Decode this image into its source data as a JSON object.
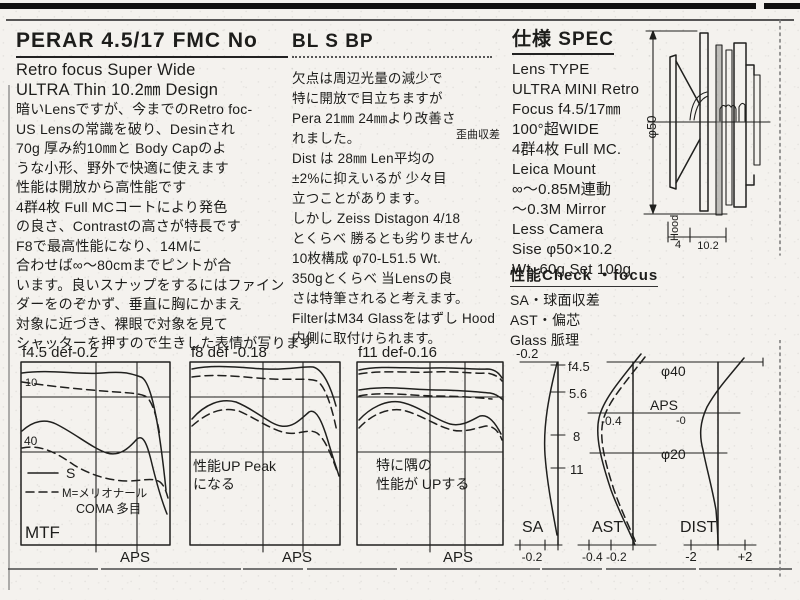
{
  "left": {
    "title": "PERAR 4.5/17 FMC No",
    "lines": [
      "Retro focus Super Wide",
      "ULTRA Thin 10.2㎜ Design",
      "暗いLensですが、今までのRetro foc-",
      "US Lensの常識を破り、Desinされ",
      "70g 厚み約10㎜と Body Capのよ",
      "うな小形、野外で快適に使えます",
      "性能は開放から高性能です",
      "4群4枚 Full MCコートにより発色",
      "の良さ、Contrastの高さが特長です",
      "F8で最高性能になり、14Mに",
      "合わせば∞〜80cmまでピントが合",
      "います。良いスナップをするにはファイン",
      "ダーをのぞかず、垂直に胸にかまえ",
      "対象に近づき、裸眼で対象を見て",
      "シャッターを押すので生きした表情が写ります"
    ]
  },
  "middle": {
    "title": "BL S BP",
    "annotation": "歪曲収差",
    "lines": [
      "欠点は周辺光量の減少で",
      "特に開放で目立ちますが",
      "Pera 21㎜ 24㎜より改善さ",
      "れました。",
      "Dist は 28㎜ Len平均の",
      "±2%に抑えいるが 少々目",
      "立つことがあります。",
      "しかし Zeiss Distagon 4/18",
      "とくらべ 勝るとも劣りません",
      "10枚構成 φ70-L51.5 Wt.",
      "350gとくらべ 当Lensの良",
      "さは特筆されると考えます。",
      "FilterはM34 Glassをはずし Hood",
      "内側に取付けられます。"
    ]
  },
  "spec": {
    "title": "仕様 SPEC",
    "lines": [
      "Lens TYPE",
      "ULTRA MINI Retro",
      "Focus f4.5/17㎜",
      "100°超WIDE",
      "4群4枚 Full MC.",
      "Leica Mount",
      "∞〜0.85M連動",
      "〜0.3M Mirror",
      "Less Camera",
      "Sise φ50×10.2",
      "Wt. 60g Set 100g"
    ]
  },
  "check": {
    "title": "性能Check ・focus",
    "lines": [
      "SA・球面収差",
      "AST・偏芯",
      "Glass 脈理"
    ]
  },
  "diagram": {
    "diameter": "φ50",
    "hood": "Hood",
    "dim_a": "4",
    "dim_b": "10.2"
  },
  "charts": {
    "mtf1": {
      "title": "f4.5 def-0.2",
      "freq_hi": "10",
      "freq_lo": "40",
      "legend_s": "S",
      "legend_m": "M=メリオナール",
      "legend_note": "COMA 多目",
      "corner": "MTF",
      "xlabel": "APS"
    },
    "mtf2": {
      "title": "f8 def -0.18",
      "note1": "性能UP Peak",
      "note2": "になる",
      "xlabel": "APS"
    },
    "mtf3": {
      "title": "f11 def-0.16",
      "note1": "特に隅の",
      "note2": "性能が UPする",
      "xlabel": "APS"
    },
    "sa": {
      "top": "-0.2",
      "stop1": "f4.5",
      "stop2": "5.6",
      "stop3": "8",
      "stop4": "11",
      "name": "SA",
      "bottom": "-0.2"
    },
    "ast": {
      "label": "-0.4",
      "name": "AST",
      "bottom": "-0.4 -0.2"
    },
    "dist": {
      "d40": "φ40",
      "aps": "APS",
      "minus0": "-0",
      "d20": "φ20",
      "name": "DIST",
      "neg": "-2",
      "pos": "+2"
    }
  },
  "chart_data": [
    {
      "type": "line",
      "title": "f4.5 def-0.2",
      "ylabel": "MTF",
      "xlabel": "image height → APS corner",
      "x": [
        0,
        0.25,
        0.5,
        0.75,
        1
      ],
      "series": [
        {
          "name": "10 lp/mm S",
          "style": "solid",
          "values": [
            0.93,
            0.92,
            0.92,
            0.9,
            0.55
          ]
        },
        {
          "name": "10 lp/mm M",
          "style": "dashed",
          "values": [
            0.88,
            0.85,
            0.82,
            0.78,
            0.62
          ]
        },
        {
          "name": "40 lp/mm S",
          "style": "solid",
          "values": [
            0.62,
            0.55,
            0.45,
            0.52,
            0.12
          ]
        },
        {
          "name": "40 lp/mm M",
          "style": "dashed",
          "values": [
            0.52,
            0.42,
            0.33,
            0.3,
            0.2
          ]
        }
      ],
      "annotations": [
        "S",
        "M=メリオナール",
        "COMA 多目",
        "MTF",
        "APS"
      ]
    },
    {
      "type": "line",
      "title": "f8 def -0.18",
      "ylabel": "MTF",
      "xlabel": "image height → APS corner",
      "x": [
        0,
        0.25,
        0.5,
        0.75,
        1
      ],
      "series": [
        {
          "name": "10 lp/mm S",
          "style": "solid",
          "values": [
            0.95,
            0.95,
            0.94,
            0.95,
            0.7
          ]
        },
        {
          "name": "10 lp/mm M",
          "style": "dashed",
          "values": [
            0.9,
            0.88,
            0.87,
            0.88,
            0.55
          ]
        },
        {
          "name": "40 lp/mm S",
          "style": "solid",
          "values": [
            0.68,
            0.72,
            0.6,
            0.65,
            0.35
          ]
        },
        {
          "name": "40 lp/mm M",
          "style": "dashed",
          "values": [
            0.64,
            0.66,
            0.56,
            0.58,
            0.38
          ]
        }
      ],
      "annotations": [
        "性能UP Peakになる",
        "APS"
      ]
    },
    {
      "type": "line",
      "title": "f11 def-0.16",
      "ylabel": "MTF",
      "xlabel": "image height → APS corner",
      "x": [
        0,
        0.25,
        0.5,
        0.75,
        1
      ],
      "series": [
        {
          "name": "10 lp/mm S",
          "style": "solid",
          "values": [
            0.94,
            0.95,
            0.94,
            0.94,
            0.9
          ]
        },
        {
          "name": "10 lp/mm M",
          "style": "dashed",
          "values": [
            0.86,
            0.88,
            0.86,
            0.85,
            0.82
          ]
        },
        {
          "name": "40 lp/mm S",
          "style": "solid",
          "values": [
            0.65,
            0.73,
            0.62,
            0.66,
            0.55
          ]
        },
        {
          "name": "40 lp/mm M",
          "style": "dashed",
          "values": [
            0.6,
            0.68,
            0.58,
            0.6,
            0.52
          ]
        }
      ],
      "annotations": [
        "特に隅の性能がUPする",
        "APS"
      ]
    },
    {
      "type": "line",
      "title": "SA (spherical aberration)",
      "xlabel": "mm",
      "xlim": [
        -0.2,
        0
      ],
      "y_ticks": [
        "f4.5",
        "5.6",
        "8",
        "11"
      ],
      "series": [
        {
          "name": "SA",
          "values_x_at_stops": [
            -0.02,
            -0.05,
            -0.045,
            -0.02
          ]
        }
      ]
    },
    {
      "type": "line",
      "title": "AST (astigmatism)",
      "xlabel": "mm",
      "xlim": [
        -0.4,
        0.2
      ],
      "y_marks": [
        "φ40",
        "APS",
        "φ20"
      ],
      "series": [
        {
          "name": "S",
          "style": "solid",
          "peak_x": -0.4
        },
        {
          "name": "M",
          "style": "dashed",
          "peak_x": -0.38
        }
      ]
    },
    {
      "type": "line",
      "title": "DIST (distortion %)",
      "xlabel": "%",
      "xlim": [
        -2,
        2
      ],
      "y_marks": [
        "φ40",
        "APS -0",
        "φ20"
      ],
      "series": [
        {
          "name": "DIST",
          "values": [
            0.8,
            -0.3,
            -0.5,
            0
          ]
        }
      ]
    }
  ]
}
